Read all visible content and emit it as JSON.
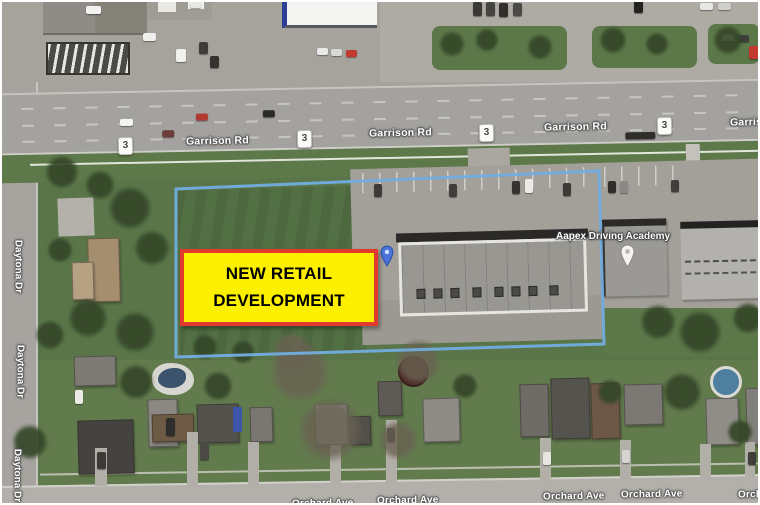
{
  "annotation_box": {
    "line1": "NEW RETAIL",
    "line2": "DEVELOPMENT",
    "bg_color": "#fcf000",
    "border_color": "#e23a2c",
    "text_color": "#000000"
  },
  "property_boundary": {
    "color": "#72ade0"
  },
  "roads": {
    "garrison": {
      "name": "Garrison Rd",
      "shield": "3"
    },
    "daytona": {
      "name": "Daytona Dr"
    },
    "orchard": {
      "name": "Orchard Ave"
    }
  },
  "poi": {
    "name": "Aapex Driving Academy"
  },
  "icons": {
    "blue_pin": "map-pin-blue",
    "white_pin": "map-pin-white"
  }
}
